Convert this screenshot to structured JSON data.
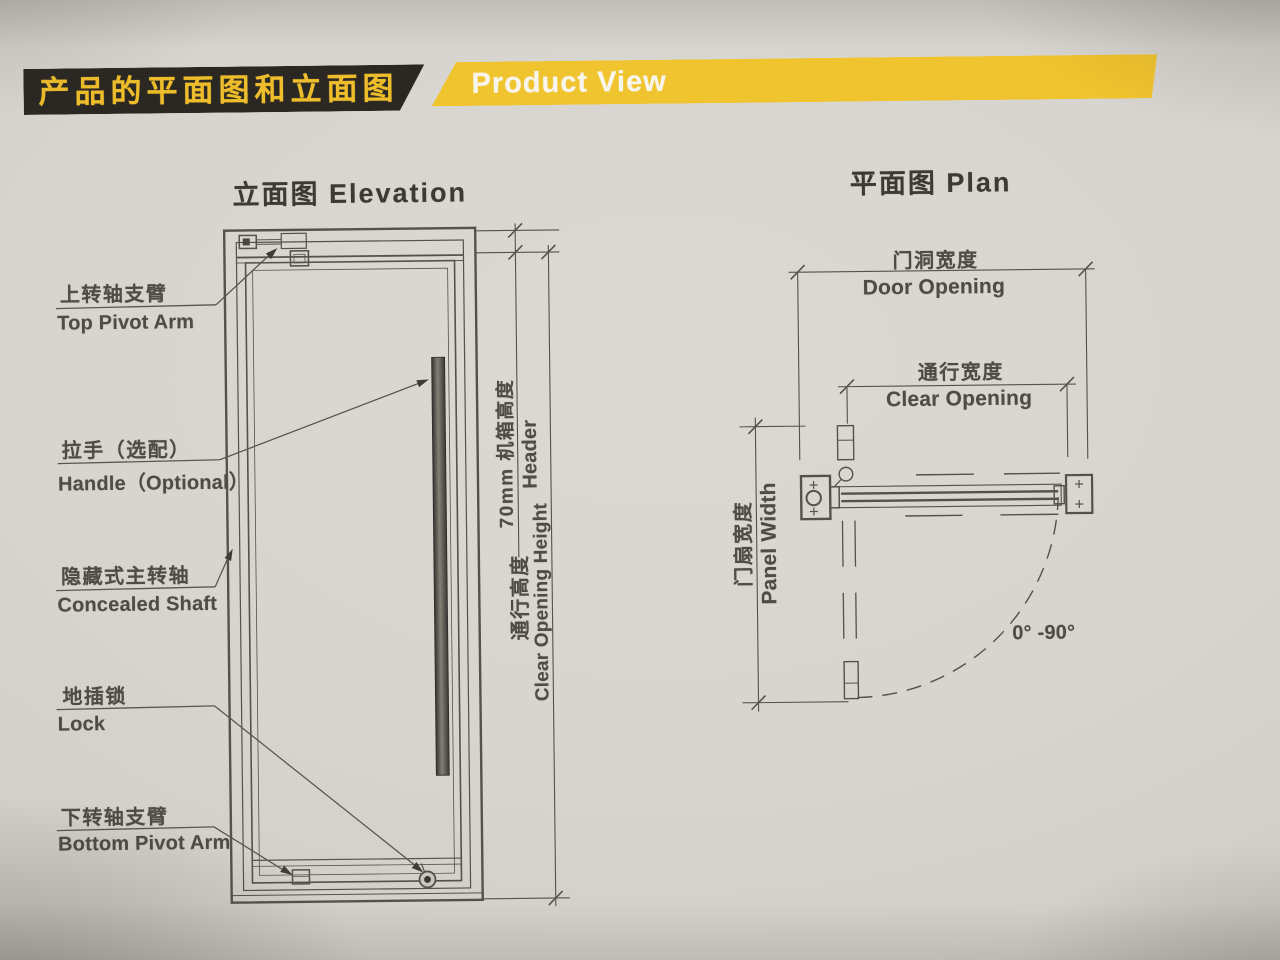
{
  "colors": {
    "paper": "#d7d4cf",
    "line": "#55524d",
    "bar_black": "#2b2723",
    "bar_yellow": "#f0c42e",
    "header_cn_text": "#edbd2b",
    "header_en_text": "#f8f5ef",
    "ink": "#4f4c47"
  },
  "header": {
    "cn_title": "产品的平面图和立面图",
    "en_title": "Product View"
  },
  "elevation": {
    "title": "立面图 Elevation",
    "labels": {
      "top_pivot_arm_cn": "上转轴支臂",
      "top_pivot_arm_en": "Top Pivot Arm",
      "handle_cn": "拉手（选配）",
      "handle_en": "Handle（Optional）",
      "concealed_shaft_cn": "隐藏式主转轴",
      "concealed_shaft_en": "Concealed Shaft",
      "lock_cn": "地插锁",
      "lock_en": "Lock",
      "bottom_pivot_arm_cn": "下转轴支臂",
      "bottom_pivot_arm_en": "Bottom Pivot Arm"
    },
    "dims": {
      "header_height_cn": "70mm 机箱高度",
      "header_height_en": "Header",
      "clear_opening_height_cn": "通行高度",
      "clear_opening_height_en": "Clear Opening Height"
    }
  },
  "plan": {
    "title": "平面图 Plan",
    "dims": {
      "door_opening_cn": "门洞宽度",
      "door_opening_en": "Door Opening",
      "clear_opening_cn": "通行宽度",
      "clear_opening_en": "Clear Opening",
      "panel_width_cn": "门扇宽度",
      "panel_width_en": "Panel Width",
      "swing_angle": "0° -90°"
    }
  }
}
